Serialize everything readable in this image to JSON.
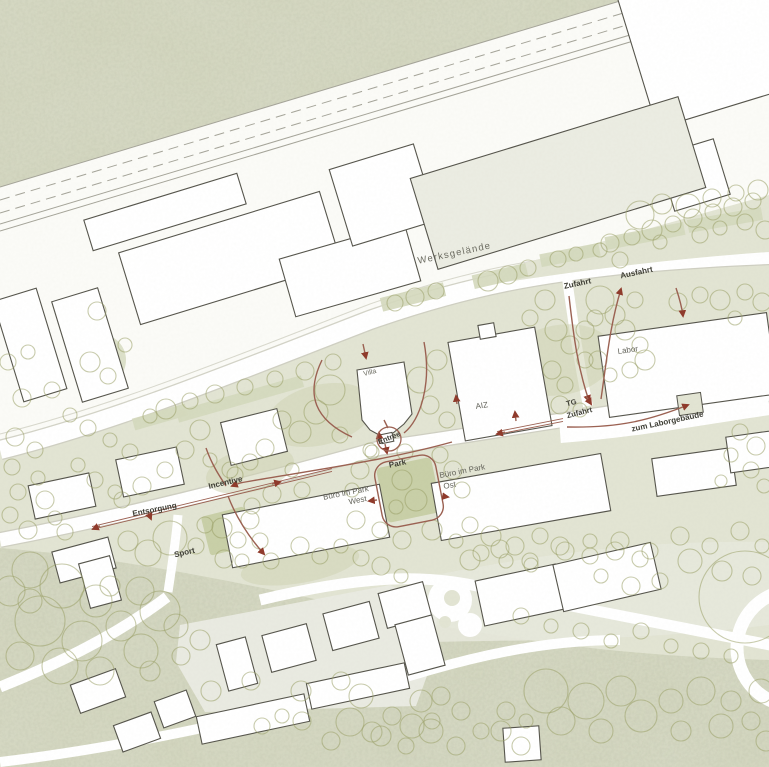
{
  "map_labels": {
    "werksgelaende": "Werksgelände",
    "zufahrt": "Zufahrt",
    "ausfahrt": "Ausfahrt",
    "labor": "Labor",
    "villa": "Villa",
    "aiz": "AIZ",
    "entree": "Entree",
    "park": "Park",
    "tg_zufahrt_line1": "TG",
    "tg_zufahrt_line2": "Zufahrt",
    "zum_laborgebaeude": "zum Laborgebäude",
    "buero_west_line1": "Büro im Park",
    "buero_west_line2": "West",
    "buero_ost_line1": "Büro im Park",
    "buero_ost_line2": "Ost",
    "entsorgung": "Entsorgung",
    "incentive": "Incentive",
    "sport": "Sport"
  },
  "colors": {
    "outer_green": "#d2d5be",
    "factory_zone": "#fbfbf7",
    "campus_sage": "#e2e4d3",
    "road_white": "#ffffff",
    "road_edge": "#cbcbbe",
    "strip_olive": "#d4d8bd",
    "lawn": "#cfd4b5",
    "park_green": "#c8cfa7",
    "building_fill": "#ffffff",
    "building_gray": "#ebece2",
    "building_stroke": "#56554c",
    "tree_stroke": "#9aa167",
    "rail_line": "#a5a499",
    "flow_stroke": "#9b6152",
    "arrow_fill": "#8f3a2b",
    "plaza": "#e9eae1"
  }
}
